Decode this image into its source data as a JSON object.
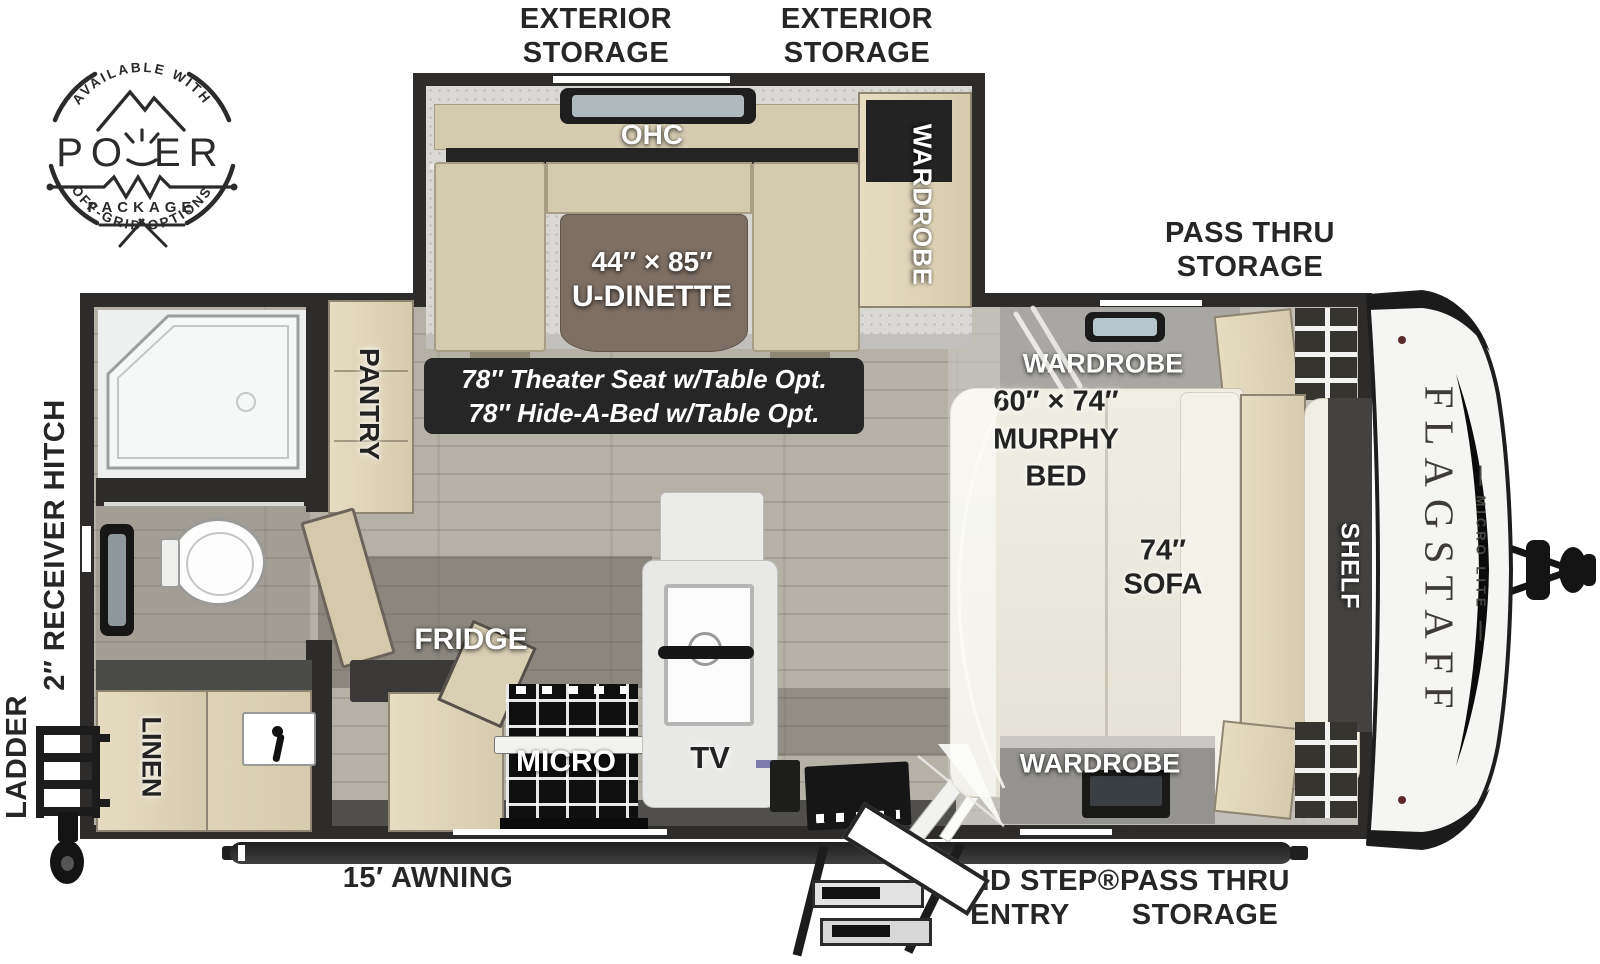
{
  "badge": {
    "arc_top": "AVAILABLE WITH",
    "title_left": "PO",
    "title_right": "ER",
    "subtitle": "PACKAGE",
    "arc_bottom": "OFF-GRID OPTIONS"
  },
  "exterior": {
    "exterior_storage_left": {
      "line1": "EXTERIOR",
      "line2": "STORAGE"
    },
    "exterior_storage_right": {
      "line1": "EXTERIOR",
      "line2": "STORAGE"
    },
    "pass_thru_top": {
      "line1": "PASS THRU",
      "line2": "STORAGE"
    },
    "awning": "15′ AWNING",
    "solid_step": {
      "line1": "SOLID STEP®",
      "line2": "ENTRY"
    },
    "pass_thru_bottom": {
      "line1": "PASS THRU",
      "line2": "STORAGE"
    },
    "receiver_hitch": "2″ RECEIVER HITCH",
    "ladder": "LADDER"
  },
  "slideout": {
    "ohc": "OHC",
    "wardrobe": "WARDROBE",
    "dinette_line1": "44″ × 85″",
    "dinette_line2": "U-DINETTE"
  },
  "options_note": {
    "line1": "78″ Theater Seat w/Table Opt.",
    "line2": "78″ Hide-A-Bed w/Table Opt."
  },
  "kitchen": {
    "pantry": "PANTRY",
    "fridge": "FRIDGE",
    "micro": "MICRO",
    "tv": "TV"
  },
  "bath": {
    "linen": "LINEN"
  },
  "bedroom": {
    "wardrobe_top": "WARDROBE",
    "murphy_line1": "60″ × 74″",
    "murphy_line2": "MURPHY",
    "murphy_line3": "BED",
    "sofa_line1": "74″",
    "sofa_line2": "SOFA",
    "shelf": "SHELF",
    "wardrobe_bottom": "WARDROBE"
  },
  "brand": {
    "name": "FLAGSTAFF",
    "series": "MICRO LITE"
  }
}
